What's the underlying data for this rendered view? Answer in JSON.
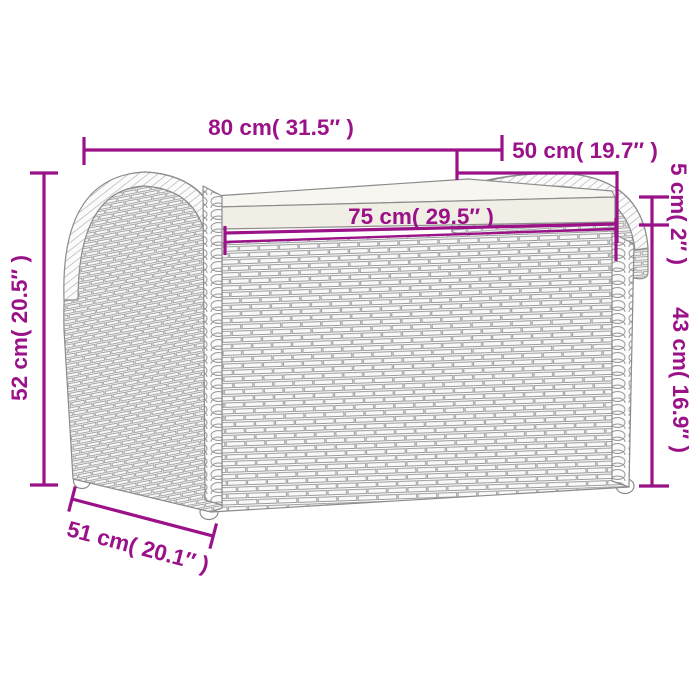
{
  "colors": {
    "dimension": "#9a1188",
    "lineart": "#8c8c8c",
    "cushion_front": "#f1eee5",
    "cushion_top": "#f8f6f0",
    "background": "#ffffff"
  },
  "dimensions": {
    "top_width": "80 cm( 31.5″ )",
    "top_depth": "50 cm( 19.7″ )",
    "seat_width": "75 cm( 29.5″ )",
    "cushion_thickness": "5 cm( 2″ )",
    "box_height": "43 cm( 16.9″ )",
    "total_height": "52 cm( 20.5″ )",
    "base_depth": "51 cm( 20.1″ )"
  }
}
